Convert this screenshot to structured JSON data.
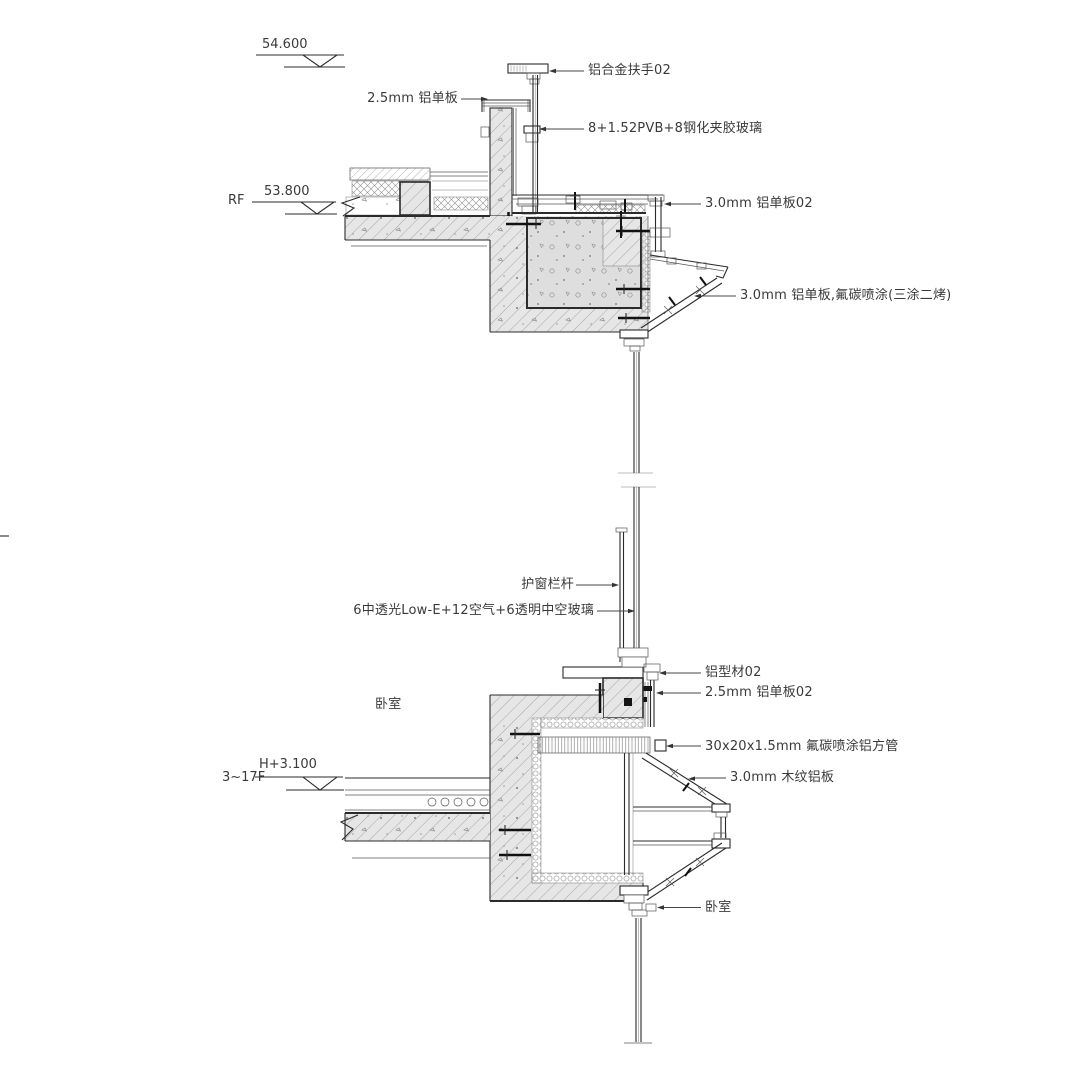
{
  "drawing": {
    "type": "architectural facade section detail"
  },
  "levels": {
    "parapet_value": "54.600",
    "roof_name": "RF",
    "roof_value": "53.800",
    "floor_name": "3~17F",
    "floor_value": "H+3.100"
  },
  "labels": {
    "handrail": "铝合金扶手02",
    "panel_2_5": "2.5mm 铝单板",
    "laminated_glass": "8+1.52PVB+8钢化夹胶玻璃",
    "panel_3_0_02": "3.0mm 铝单板02",
    "panel_3_0_fc": "3.0mm 铝单板,氟碳喷涂(三涂二烤)",
    "guard_rail": "护窗栏杆",
    "insulated_glass": "6中透光Low-E+12空气+6透明中空玻璃",
    "profile_02": "铝型材02",
    "panel_2_5_02": "2.5mm 铝单板02",
    "square_tube": "30x20x1.5mm 氟碳喷涂铝方管",
    "wood_panel": "3.0mm 木纹铝板",
    "bedroom_upper": "卧室",
    "bedroom_lower": "卧室"
  },
  "colors": {
    "background": "#ffffff",
    "line": "#2b2b2b",
    "line_fine": "#565656",
    "hatch_line": "#9e9e9e",
    "fill_concrete": "#e6e6e6",
    "fill_beam": "#dedede",
    "text": "#3a3a3a"
  }
}
